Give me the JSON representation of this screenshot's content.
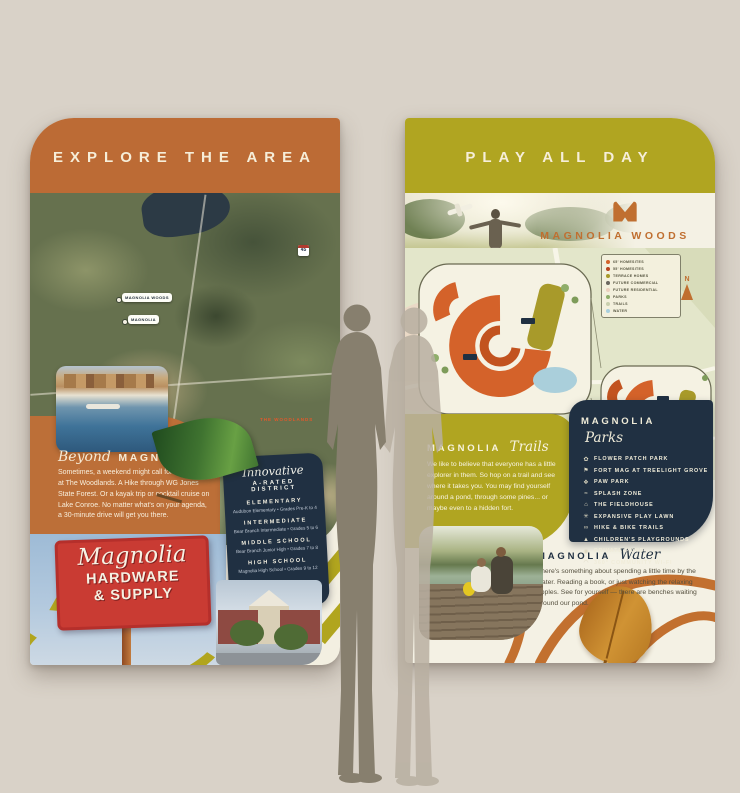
{
  "left_banner": {
    "header": "EXPLORE THE AREA",
    "map_markers": {
      "pill1": "MAGNOLIA WOODS",
      "pill2": "MAGNOLIA",
      "shield1": "45",
      "shield2": "249",
      "area_label": "THE WOODLANDS"
    },
    "beyond": {
      "heading_script": "Beyond",
      "heading_caps": "MAGNOLIA",
      "body": "Sometimes, a weekend might call for shopping at The Woodlands. A Hike through WG Jones State Forest. Or a kayak trip or cocktail cruise on Lake Conroe. No matter what's on your agenda, a 30-minute drive will get you there."
    },
    "sign": {
      "script": "Magnolia",
      "line1": "HARDWARE",
      "line2": "& SUPPLY"
    },
    "district_card": {
      "heading_script": "Innovative",
      "heading_caps": "A-RATED DISTRICT",
      "schools": [
        {
          "level": "ELEMENTARY",
          "detail": "Audubon Elementary  •  Grades Pre-K to 4"
        },
        {
          "level": "INTERMEDIATE",
          "detail": "Bear Branch Intermediate  •  Grades 5 to 6"
        },
        {
          "level": "MIDDLE SCHOOL",
          "detail": "Bear Branch Junior High  •  Grades 7 to 8"
        },
        {
          "level": "HIGH SCHOOL",
          "detail": "Magnolia High School  •  Grades 9 to 12"
        }
      ]
    }
  },
  "right_banner": {
    "header": "PLAY ALL DAY",
    "woods_title": "MAGNOLIA WOODS",
    "north_label": "N",
    "map_disclaimer": "ILLUSTRATIVE MAP. ALL FEATURES AND LOCATIONS SUBJECT TO CHANGE.",
    "legend": [
      {
        "label": "65' HOMESITES",
        "color": "#d4622a"
      },
      {
        "label": "55' HOMESITES",
        "color": "#b8431f"
      },
      {
        "label": "TERRACE HOMES",
        "color": "#a89a2a"
      },
      {
        "label": "FUTURE COMMERCIAL",
        "color": "#6b675f"
      },
      {
        "label": "FUTURE RESIDENTIAL",
        "color": "#eccfbd"
      },
      {
        "label": "PARKS",
        "color": "#8fae6a"
      },
      {
        "label": "TRAILS",
        "color": "#c9cfae"
      },
      {
        "label": "WATER",
        "color": "#a8cfdd"
      }
    ],
    "trails": {
      "heading_caps": "MAGNOLIA",
      "heading_script": "Trails",
      "body": "We like to believe that everyone has a little explorer in them. So hop on a trail and see where it takes you. You may find yourself around a pond, through some pines... or maybe even to a hidden fort."
    },
    "parks_card": {
      "heading_caps": "MAGNOLIA",
      "heading_script": "Parks",
      "items": [
        {
          "glyph": "✿",
          "label": "FLOWER PATCH PARK"
        },
        {
          "glyph": "⚑",
          "label": "FORT MAG AT TREELIGHT GROVE"
        },
        {
          "glyph": "❖",
          "label": "PAW PARK"
        },
        {
          "glyph": "≈",
          "label": "SPLASH ZONE"
        },
        {
          "glyph": "⌂",
          "label": "THE FIELDHOUSE"
        },
        {
          "glyph": "✳",
          "label": "EXPANSIVE PLAY LAWN"
        },
        {
          "glyph": "∞",
          "label": "HIKE & BIKE TRAILS"
        },
        {
          "glyph": "▲",
          "label": "CHILDREN'S PLAYGROUNDS"
        },
        {
          "glyph": "◉",
          "label": "PRIVATE POND"
        },
        {
          "glyph": "◠",
          "label": "360° COMMUNITY WI-FI"
        }
      ]
    },
    "water": {
      "heading_caps": "MAGNOLIA",
      "heading_script": "Water",
      "body": "There's something about spending a little time by the water. Reading a book, or just watching the relaxing ripples. See for yourself — there are benches waiting around our pond."
    }
  },
  "colors": {
    "background": "#d9d2c8",
    "accent_orange": "#bc6b35",
    "accent_olive": "#b0a521",
    "navy_card": "#203042",
    "cream": "#f3efe1",
    "sign_red": "#c93b33",
    "homesite_orange": "#d4622a",
    "pond_blue": "#a8cfdd",
    "leaf_green": "#3f7330",
    "leaf_gold": "#d09334"
  }
}
